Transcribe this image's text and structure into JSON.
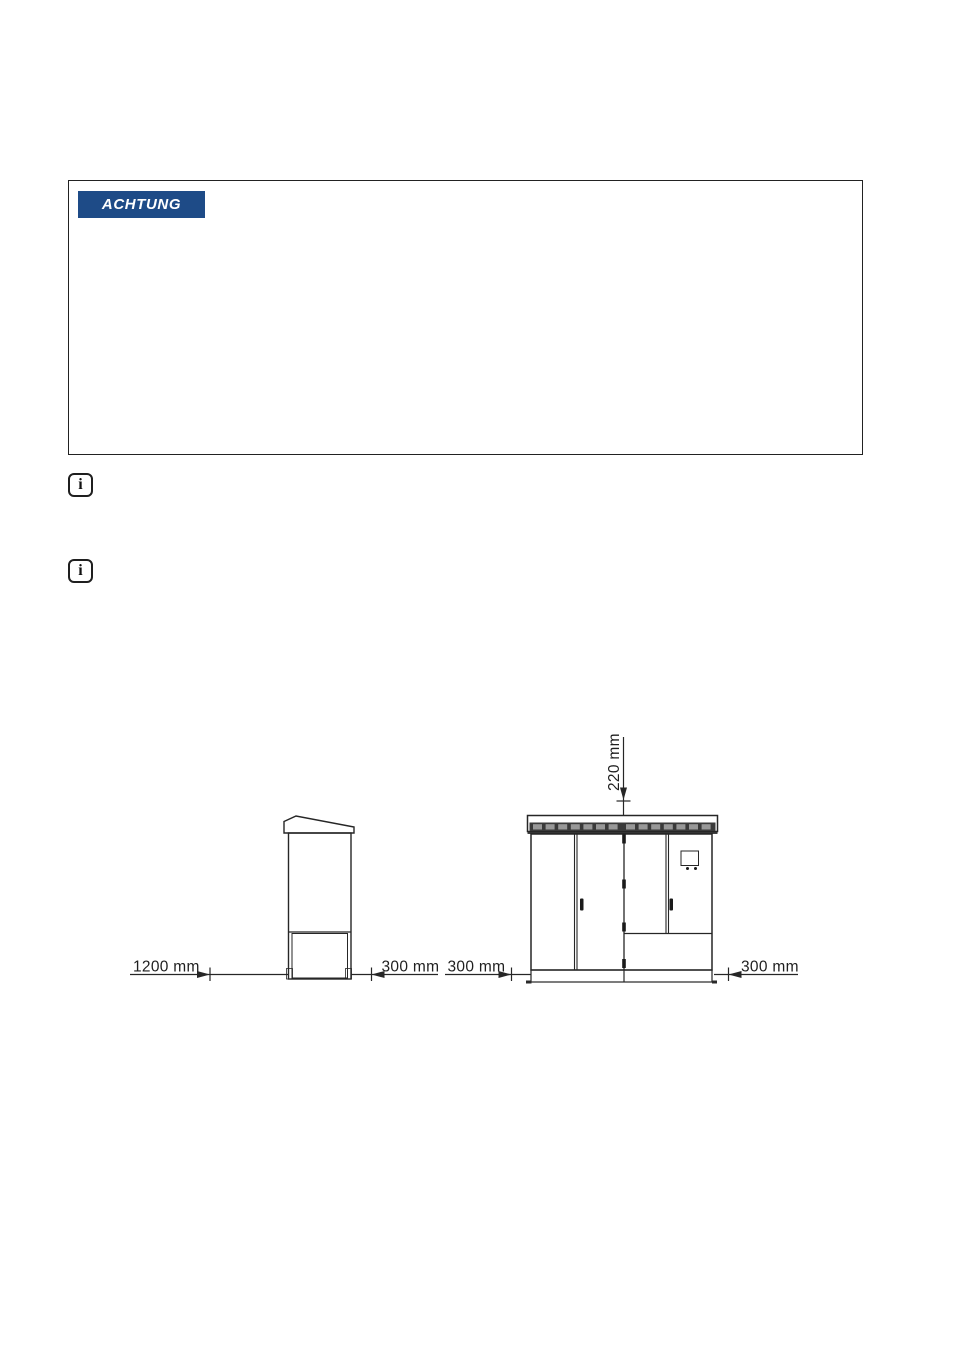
{
  "warning_box": {
    "label": "ACHTUNG",
    "badge_color": "#1e4b87",
    "label_color": "#ffffff"
  },
  "info_icons": [
    {
      "glyph": "i"
    },
    {
      "glyph": "i"
    }
  ],
  "diagram": {
    "type": "clearance-dimension-drawing",
    "side_view": {
      "left_clearance": "1200 mm",
      "right_clearance": "300 mm"
    },
    "front_view": {
      "left_clearance": "300 mm",
      "right_clearance": "300 mm",
      "top_clearance": "220 mm"
    },
    "colors": {
      "cabinet_body": "#edf4f8",
      "cabinet_gray": "#989898",
      "vent_strip": "#3a3a3a",
      "hardware_dark": "#1a1a1a",
      "display_fill": "#4a4a4a",
      "foot_dark": "#4b4b4b",
      "outline": "#262626"
    }
  }
}
